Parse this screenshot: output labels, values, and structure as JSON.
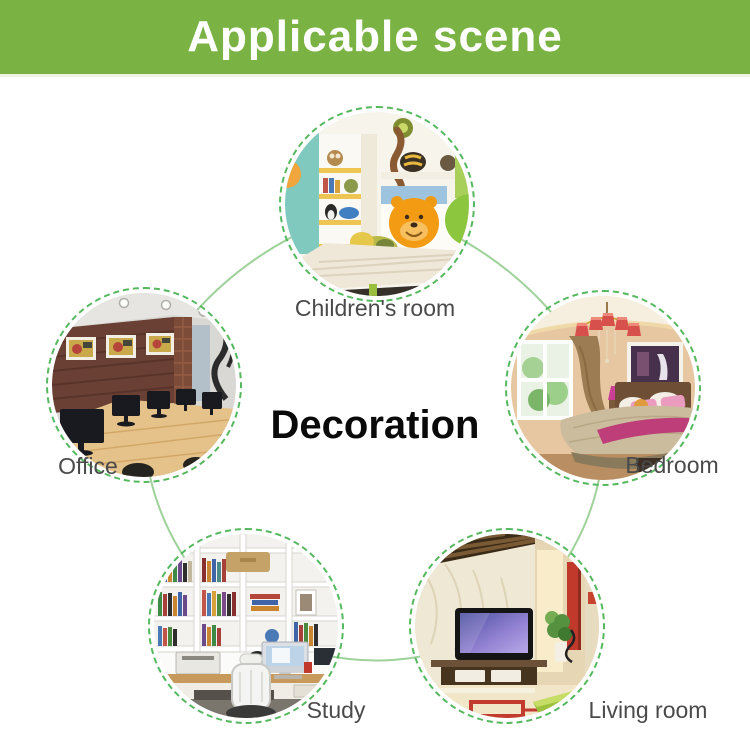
{
  "banner": {
    "title": "Applicable scene",
    "background_color": "#7ab344",
    "text_color": "#ffffff"
  },
  "diagram": {
    "center_title": "Decoration",
    "ring_color": "#55b85e",
    "connector_color": "#9fd29a",
    "label_color": "#4a4a4a"
  },
  "scenes": [
    {
      "id": "childrens-room",
      "label": "Children's room",
      "position": "top"
    },
    {
      "id": "office",
      "label": "Office",
      "position": "left"
    },
    {
      "id": "bedroom",
      "label": "Bedroom",
      "position": "right"
    },
    {
      "id": "study",
      "label": "Study",
      "position": "bottom-left"
    },
    {
      "id": "living-room",
      "label": "Living room",
      "position": "bottom-right"
    }
  ]
}
